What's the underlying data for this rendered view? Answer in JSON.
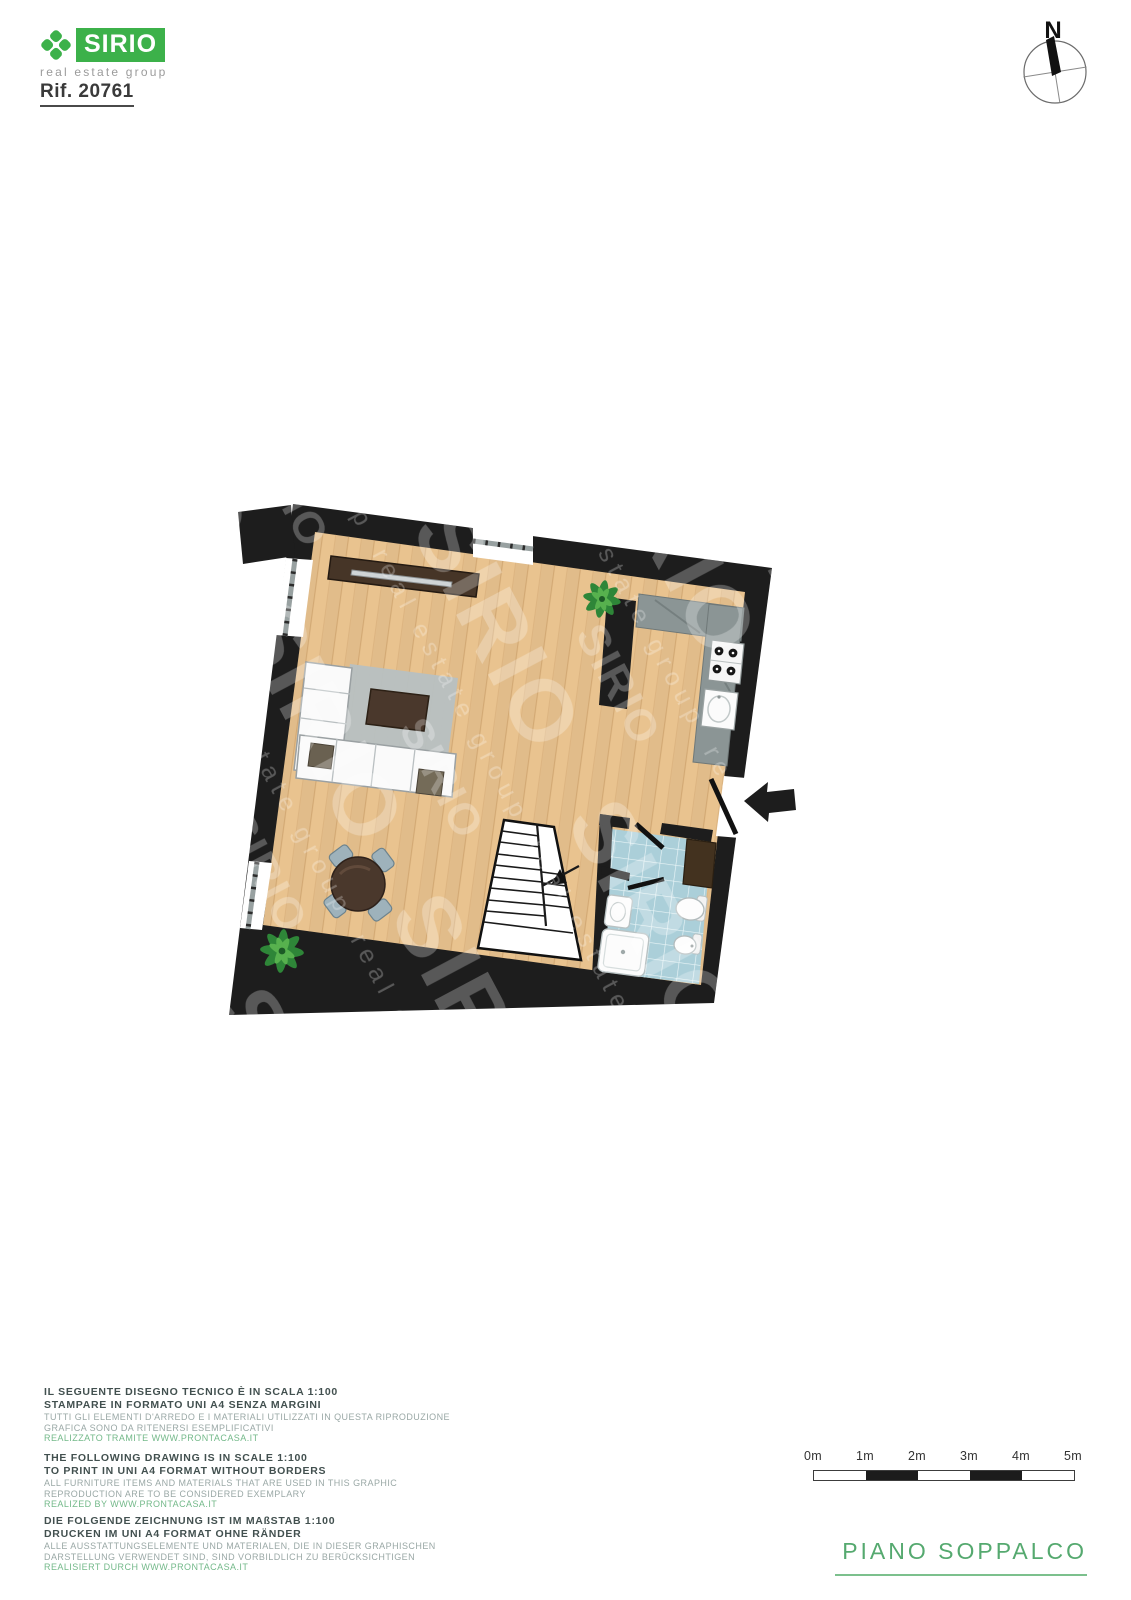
{
  "header": {
    "brand": "SIRIO",
    "tagline": "real estate group",
    "reference": "Rif. 20761"
  },
  "compass": {
    "label": "N"
  },
  "watermark": {
    "brand": "SIRIO",
    "tagline": "real estate group"
  },
  "plan": {
    "title": "PIANO SOPPALCO",
    "scale_note": "1:100",
    "rooms": [
      {
        "name": "living-dining-area",
        "floor": "wood"
      },
      {
        "name": "kitchen",
        "floor": "wood"
      },
      {
        "name": "bathroom",
        "floor": "blue-tile"
      },
      {
        "name": "staircase",
        "direction": "up"
      }
    ],
    "furniture": [
      "tv-sideboard",
      "corner-sofa",
      "rug",
      "coffee-table",
      "floor-cushions",
      "round-dining-table",
      "dining-chairs",
      "plant",
      "plant",
      "kitchen-counter",
      "cooktop-4-burners",
      "kitchen-sink",
      "shower",
      "bathroom-sink",
      "toilet",
      "bidet",
      "bathroom-cabinet"
    ],
    "entry": "door-with-arrow-right-wall"
  },
  "disclaimer": {
    "it": {
      "bold1": "IL SEGUENTE DISEGNO TECNICO È IN SCALA 1:100",
      "bold2": "STAMPARE IN FORMATO UNI A4 SENZA MARGINI",
      "gray1": "TUTTI GLI ELEMENTI D'ARREDO E I MATERIALI UTILIZZATI IN QUESTA RIPRODUZIONE",
      "gray2": "GRAFICA SONO DA RITENERSI ESEMPLIFICATIVI",
      "link": "REALIZZATO TRAMITE WWW.PRONTACASA.IT"
    },
    "en": {
      "bold1": "THE FOLLOWING DRAWING IS IN SCALE 1:100",
      "bold2": "TO PRINT IN UNI A4 FORMAT WITHOUT BORDERS",
      "gray1": "ALL FURNITURE ITEMS AND MATERIALS THAT ARE USED IN THIS GRAPHIC",
      "gray2": "REPRODUCTION ARE TO BE CONSIDERED EXEMPLARY",
      "link": "REALIZED BY WWW.PRONTACASA.IT"
    },
    "de": {
      "bold1": "DIE FOLGENDE ZEICHNUNG IST IM MAßSTAB 1:100",
      "bold2": "DRUCKEN IM UNI A4 FORMAT OHNE RÄNDER",
      "gray1": "ALLE AUSSTATTUNGSELEMENTE UND MATERIALEN, DIE IN DIESER GRAPHISCHEN",
      "gray2": "DARSTELLUNG VERWENDET SIND, SIND VORBILDLICH ZU BERÜCKSICHTIGEN",
      "link": "REALISIERT DURCH WWW.PRONTACASA.IT"
    }
  },
  "scale_bar": {
    "labels": [
      "0m",
      "1m",
      "2m",
      "3m",
      "4m",
      "5m"
    ]
  },
  "colors": {
    "brand_green": "#3cb14a",
    "title_green": "#55a96f",
    "link_green": "#74b98a",
    "text_dark": "#42504f",
    "text_gray": "#9aa8a6",
    "wall": "#1d1d1d",
    "floor_wood": "#e9c38f",
    "tile_blue": "#abcfd9",
    "counter_gray": "#8b9595",
    "rug_gray": "#b7c0c2",
    "wood_dark": "#4a382c",
    "chair_gray": "#9eb2bb",
    "sofa_white": "#fafafa"
  }
}
